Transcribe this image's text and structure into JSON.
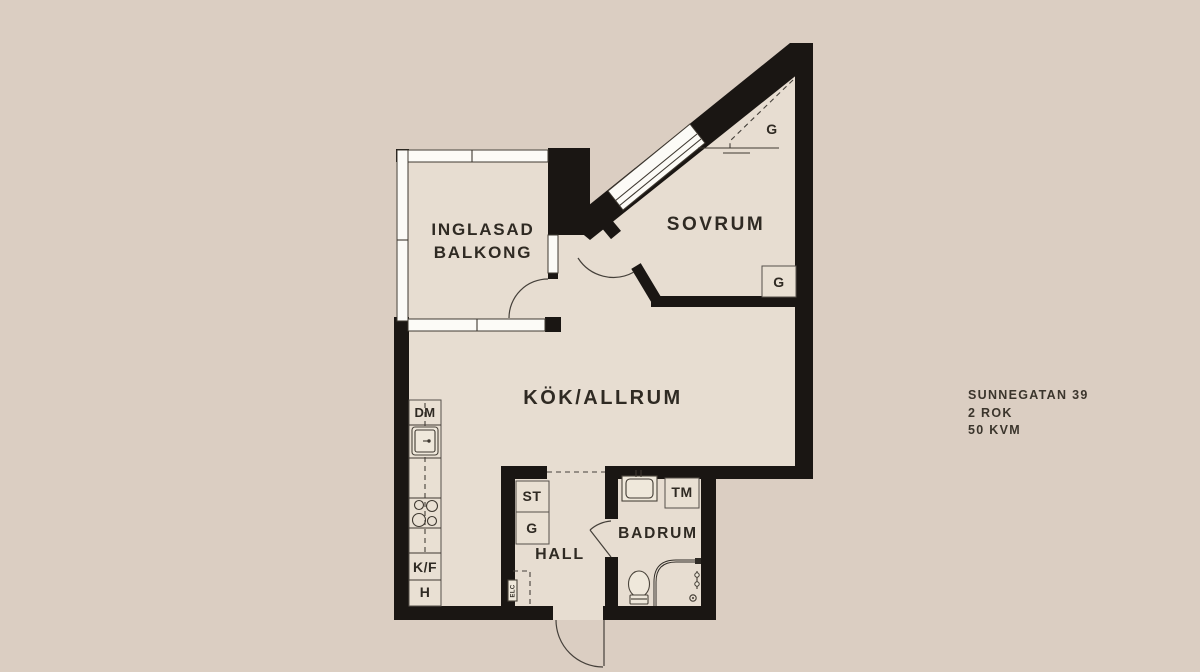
{
  "colors": {
    "background": "#dbcec2",
    "floor": "#e7ddd1",
    "wall": "#1a1613",
    "window_white": "#fcfbf7",
    "line": "#3f3931",
    "text": "#2f2a23"
  },
  "info_block": {
    "address": "SUNNEGATAN 39",
    "rooms": "2 ROK",
    "area": "50 KVM"
  },
  "rooms": {
    "balcony": {
      "line1": "INGLASAD",
      "line2": "BALKONG"
    },
    "bedroom": {
      "label": "SOVRUM"
    },
    "kitchen_living": {
      "label": "KÖK/ALLRUM"
    },
    "hall": {
      "label": "HALL"
    },
    "bathroom": {
      "label": "BADRUM"
    }
  },
  "fixtures": {
    "dishwasher": "DM",
    "fridge_freezer": "K/F",
    "tall_cabinet": "H",
    "hall_closet_st": "ST",
    "hall_closet_g": "G",
    "bedroom_wardrobe_sloped": "G",
    "bedroom_wardrobe": "G",
    "washing_machine": "TM",
    "electrical_cabinet": "ELC"
  }
}
